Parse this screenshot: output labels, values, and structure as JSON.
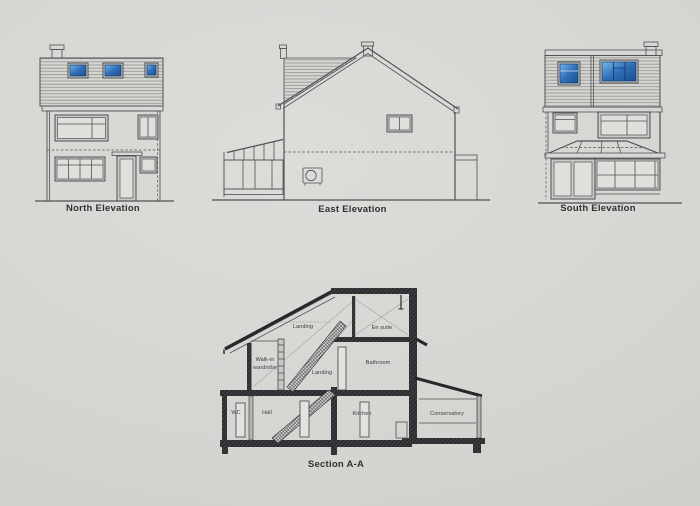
{
  "sheet": {
    "captions": {
      "north": "North Elevation",
      "east": "East Elevation",
      "south": "South Elevation",
      "section": "Section A-A"
    },
    "section_rooms": {
      "attic_landing": "Landing",
      "en_suite": "En suite",
      "walk_in_1": "Walk-in",
      "walk_in_2": "wardrobe",
      "landing": "Landing",
      "bathroom": "Bathroom",
      "wc": "WC",
      "hall": "Hall",
      "kitchen": "Kitchen",
      "conservatory": "Conservatory"
    },
    "colors": {
      "paper": "#d7d5d2",
      "line": "#4e5156",
      "line_dark": "#26282c",
      "window_blue": "#2f6fb8",
      "window_blue_light": "#79b8e8",
      "window_blue_dark": "#1b4e8f"
    }
  }
}
